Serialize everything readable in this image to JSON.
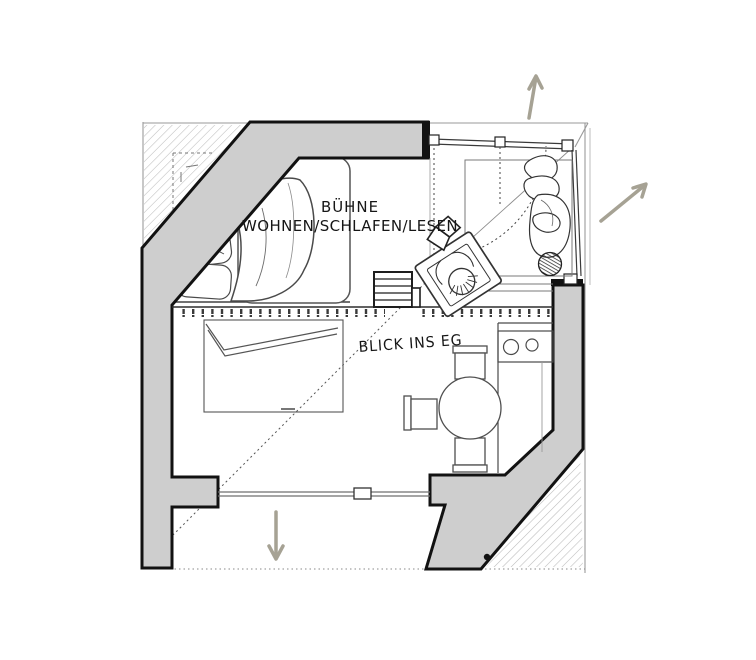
{
  "drawing": {
    "labels": {
      "stage_line1": "BÜHNE",
      "stage_line2": "WOHNEN/SCHLAFEN/LESEN",
      "view_note": "BLICK INS EG"
    },
    "arrows": [
      {
        "name": "direction-arrow-up",
        "direction": "up"
      },
      {
        "name": "direction-arrow-northeast",
        "direction": "up-right"
      },
      {
        "name": "direction-arrow-down",
        "direction": "down"
      }
    ],
    "colors": {
      "background": "#ffffff",
      "wall_fill": "#cecece",
      "wall_line": "#121212",
      "sketch_line": "#4a4a4a",
      "arrow": "#a6a294",
      "hatch": "#bcbcbc"
    }
  }
}
